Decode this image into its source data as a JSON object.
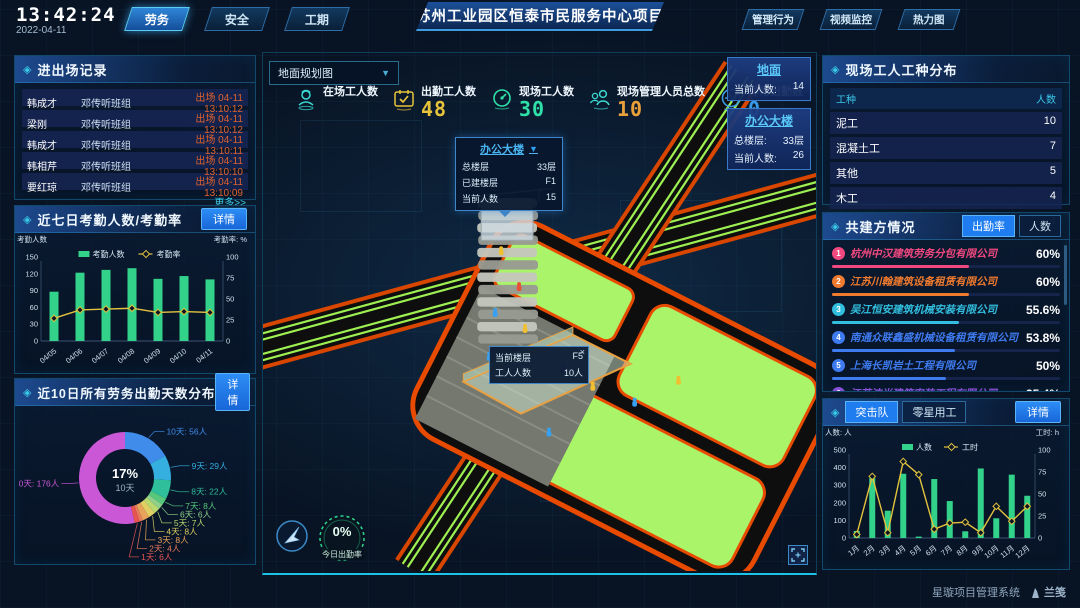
{
  "header": {
    "time": "13:42:24",
    "date": "2022-04-11",
    "tabs_left": [
      {
        "label": "劳务",
        "active": true
      },
      {
        "label": "安全",
        "active": false
      },
      {
        "label": "工期",
        "active": false
      }
    ],
    "title": "苏州工业园区恒泰市民服务中心项目",
    "tabs_right": [
      {
        "label": "管理行为",
        "active": false
      },
      {
        "label": "视频监控",
        "active": false
      },
      {
        "label": "热力图",
        "active": false
      }
    ]
  },
  "left": {
    "records": {
      "title": "进出场记录",
      "rows": [
        {
          "name": "韩成才",
          "team": "邓传听班组",
          "event": "出场 04-11 13:10:12"
        },
        {
          "name": "梁刚",
          "team": "邓传听班组",
          "event": "出场 04-11 13:10:12"
        },
        {
          "name": "韩成才",
          "team": "邓传听班组",
          "event": "出场 04-11 13:10:11"
        },
        {
          "name": "韩相芹",
          "team": "邓传听班组",
          "event": "出场 04-11 13:10:10"
        },
        {
          "name": "要红琼",
          "team": "邓传听班组",
          "event": "出场 04-11 13:10:09"
        }
      ],
      "more": "更多>>"
    },
    "attendance7": {
      "title": "近七日考勤人数/考勤率",
      "detail": "详情"
    },
    "distribution": {
      "title": "近10日所有劳务出勤天数分布",
      "detail": "详情"
    }
  },
  "center": {
    "map_select": "地面规划图",
    "stats": [
      {
        "label": "在场工人数",
        "value": "",
        "color": "#3ad8d0",
        "icon": "worker",
        "icon_color": "#3ad8d0"
      },
      {
        "label": "出勤工人数",
        "value": "48",
        "color": "#e8c33a",
        "icon": "calendar",
        "icon_color": "#e8c33a"
      },
      {
        "label": "现场工人数",
        "value": "30",
        "color": "#2fe0a8",
        "icon": "gauge",
        "icon_color": "#2fe0a8"
      },
      {
        "label": "现场管理人员总数",
        "value": "10",
        "color": "#e8a03a",
        "icon": "people",
        "icon_color": "#3ad8d0"
      },
      {
        "label": "异常出勤数",
        "value": "0",
        "color": "#3a9ae8",
        "icon": "pulse",
        "icon_color": "#3a9ae8"
      }
    ],
    "cards": [
      {
        "title": "地面",
        "rows": [
          [
            "当前人数:",
            "14"
          ]
        ]
      },
      {
        "title": "办公大楼",
        "rows": [
          [
            "总楼层:",
            "33层"
          ],
          [
            "当前人数:",
            "26"
          ]
        ]
      }
    ],
    "tower_tooltip": {
      "title": "办公大楼",
      "rows": [
        [
          "总楼层",
          "33层"
        ],
        [
          "已建楼层",
          "F1"
        ],
        [
          "当前人数",
          "15"
        ]
      ]
    },
    "floor_tooltip": {
      "rows": [
        [
          "当前楼层",
          "F5"
        ],
        [
          "工人人数",
          "10人"
        ]
      ],
      "close": "×"
    },
    "ring": {
      "value": "0%",
      "label": "今日出勤率"
    }
  },
  "right": {
    "trades": {
      "title": "现场工人工种分布",
      "headers": [
        "工种",
        "人数"
      ],
      "rows": [
        [
          "泥工",
          "10"
        ],
        [
          "混凝土工",
          "7"
        ],
        [
          "其他",
          "5"
        ],
        [
          "木工",
          "4"
        ],
        [
          "塔司",
          "4"
        ]
      ]
    },
    "partners": {
      "title": "共建方情况",
      "tabs": [
        {
          "label": "出勤率",
          "active": true
        },
        {
          "label": "人数",
          "active": false
        }
      ],
      "items": [
        {
          "rank": "1",
          "name": "杭州中汉建筑劳务分包有限公司",
          "pct": "60%",
          "color": "#f0487f"
        },
        {
          "rank": "2",
          "name": "江苏川翰建筑设备租赁有限公司",
          "pct": "60%",
          "color": "#f07a2e"
        },
        {
          "rank": "3",
          "name": "吴江恒安建筑机械安装有限公司",
          "pct": "55.6%",
          "color": "#32bede"
        },
        {
          "rank": "4",
          "name": "南通众联鑫盛机械设备租赁有限公司",
          "pct": "53.8%",
          "color": "#3f7bf0"
        },
        {
          "rank": "5",
          "name": "上海长凯岩土工程有限公司",
          "pct": "50%",
          "color": "#3f7bf0"
        },
        {
          "rank": "6",
          "name": "江苏洁尚建筑安装工程有限公司",
          "pct": "35.4%",
          "color": "#8a50d8"
        }
      ]
    },
    "team_chart": {
      "tabs": [
        {
          "label": "突击队",
          "active": true
        },
        {
          "label": "零星用工",
          "active": false
        }
      ],
      "detail": "详情"
    }
  },
  "footer": {
    "app": "星璇项目管理系统",
    "brand": "兰笺"
  },
  "colors": {
    "accent": "#2fd8f0",
    "bar_green": "#32d28a",
    "line_yellow": "#e2c23e",
    "alert_orange": "#e0622e",
    "detail_blue": "#1f7df0"
  },
  "chart_data": [
    {
      "id": "attendance7",
      "type": "bar",
      "title": "近七日考勤人数/考勤率",
      "categories": [
        "04/05",
        "04/06",
        "04/07",
        "04/08",
        "04/09",
        "04/10",
        "04/11"
      ],
      "series": [
        {
          "name": "考勤人数",
          "type": "bar",
          "axis": "left",
          "color": "#32d28a",
          "values": [
            88,
            122,
            127,
            130,
            111,
            116,
            110
          ]
        },
        {
          "name": "考勤率",
          "type": "line",
          "axis": "right",
          "color": "#e2c23e",
          "values": [
            27,
            37,
            38,
            39,
            34,
            35,
            34
          ]
        }
      ],
      "left_axis": {
        "label": "考勤人数",
        "min": 0,
        "max": 150,
        "ticks": [
          0,
          30,
          60,
          90,
          120,
          150
        ]
      },
      "right_axis": {
        "label": "考勤率: %",
        "min": 0,
        "max": 100,
        "ticks": [
          0,
          25,
          50,
          75,
          100
        ]
      },
      "legend_position": "top"
    },
    {
      "id": "distribution",
      "type": "pie",
      "title": "近10日所有劳务出勤天数分布",
      "center": {
        "pct": "17%",
        "label": "10天"
      },
      "slices": [
        {
          "label": "10天",
          "people": 56,
          "display": "10天: 56人",
          "color": "#3f8cea"
        },
        {
          "label": "9天",
          "people": 29,
          "display": "9天: 29人",
          "color": "#35aee0"
        },
        {
          "label": "8天",
          "people": 22,
          "display": "8天: 22人",
          "color": "#2fbf9a"
        },
        {
          "label": "7天",
          "people": 8,
          "display": "7天: 8人",
          "color": "#57c87b"
        },
        {
          "label": "6天",
          "people": 6,
          "display": "6天: 6人",
          "color": "#8fd08a"
        },
        {
          "label": "5天",
          "people": 7,
          "display": "5天: 7人",
          "color": "#b9d96e"
        },
        {
          "label": "4天",
          "people": 8,
          "display": "4天: 8人",
          "color": "#e0cf62"
        },
        {
          "label": "3天",
          "people": 8,
          "display": "3天: 8人",
          "color": "#e8a35a"
        },
        {
          "label": "2天",
          "people": 4,
          "display": "2天: 4人",
          "color": "#e87b5a"
        },
        {
          "label": "1天",
          "people": 6,
          "display": "1天: 6人",
          "color": "#e85450"
        },
        {
          "label": "0天",
          "people": 176,
          "display": "0天: 176人",
          "color": "#c957d6"
        }
      ]
    },
    {
      "id": "team_monthly",
      "type": "bar",
      "title": "突击队人数/工时",
      "categories": [
        "1月",
        "2月",
        "3月",
        "4月",
        "5月",
        "6月",
        "7月",
        "8月",
        "9月",
        "10月",
        "11月",
        "12月"
      ],
      "series": [
        {
          "name": "人数",
          "type": "bar",
          "axis": "left",
          "color": "#32d28a",
          "values": [
            40,
            340,
            155,
            365,
            8,
            335,
            210,
            38,
            395,
            112,
            360,
            240
          ]
        },
        {
          "name": "工时",
          "type": "line",
          "axis": "right",
          "color": "#e2c23e",
          "values": [
            4,
            70,
            6,
            87,
            72,
            10,
            17,
            18,
            6,
            36,
            19,
            36
          ]
        }
      ],
      "left_axis": {
        "label": "人数: 人",
        "min": 0,
        "max": 500,
        "ticks": [
          0,
          100,
          200,
          300,
          400,
          500
        ]
      },
      "right_axis": {
        "label": "工时: h",
        "min": 0,
        "max": 100,
        "ticks": [
          0,
          25,
          50,
          75,
          100
        ]
      },
      "legend_position": "top"
    }
  ]
}
